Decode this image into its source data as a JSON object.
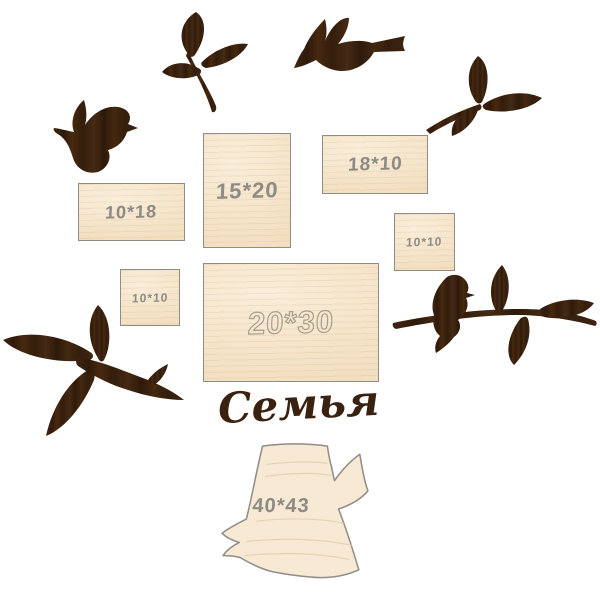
{
  "page": {
    "title_label": "Семья",
    "background": "#ffffff"
  },
  "colors": {
    "wood_light": "#f5e4c9",
    "wood_border": "#8f8d88",
    "silhouette_brown": "#3a2211",
    "engraving_gray": "#8e8b85",
    "outline_label": "#a89e8d"
  },
  "frames": [
    {
      "id": "frame-10x18",
      "label": "10*18"
    },
    {
      "id": "frame-15x20",
      "label": "15*20"
    },
    {
      "id": "frame-18x10",
      "label": "18*10"
    },
    {
      "id": "frame-10x10-right",
      "label": "10*10"
    },
    {
      "id": "frame-10x10-left",
      "label": "10*10"
    },
    {
      "id": "frame-20x30",
      "label": "20*30"
    }
  ],
  "trunk": {
    "label": "40*43"
  },
  "decor": {
    "items": [
      "flying-bird-left",
      "leaf-twig-top",
      "flying-bird-top",
      "leaf-sprig-right",
      "leaf-branch-bottom-left",
      "bird-on-branch-right"
    ]
  }
}
